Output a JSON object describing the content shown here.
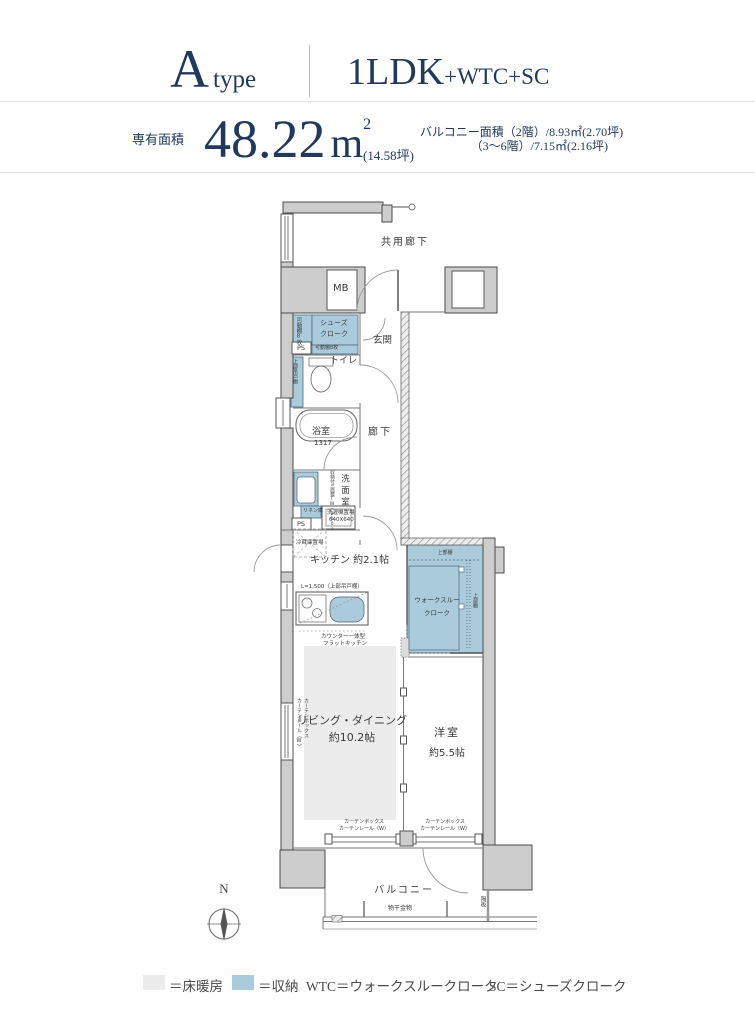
{
  "header": {
    "type_letter": "A",
    "type_word": "type",
    "plan_main": "1LDK",
    "plan_suffix": "+WTC+SC",
    "area_label": "専有面積",
    "area_value": "48.22",
    "area_unit_base": "m",
    "area_unit_sup": "2",
    "area_tsubo": "(14.58坪)",
    "balcony_line1": "バルコニー面積（2階）/8.93㎡(2.70坪)",
    "balcony_line2": "（3〜6階）/7.15㎡(2.16坪)"
  },
  "plan": {
    "common_corridor": "共用廊下",
    "mb": "MB",
    "shoes_closet_l1": "シューズ",
    "shoes_closet_l2": "クローク",
    "movable_shelf_side": "可動棚8枚",
    "movable_shelf_bottom": "可動棚8枚",
    "ps_top": "PS",
    "entrance": "玄関",
    "toilet": "トイレ",
    "hanging_cabinet": "上部吊戸棚",
    "bath": "浴室",
    "bath_size": "1317",
    "corridor": "廊下",
    "washroom": "洗面室",
    "mirror_cabinet": "収納付三面鏡(W=900)",
    "linen": "リネン庫",
    "washer_l1": "洗濯機置場",
    "washer_l2": "640X640",
    "ps_mid": "PS",
    "fridge": "冷蔵庫置場",
    "kitchen": "キッチン 約2.1帖",
    "kitchen_shelf": "L=1,500（上部吊戸棚）",
    "flat_kitchen_l1": "カウンター一体型",
    "flat_kitchen_l2": "フラットキッチン",
    "wtc_l1": "ウォークスルー",
    "wtc_l2": "クローク",
    "wtc_shelf_top": "上部棚",
    "wtc_shelf_right": "上部棚",
    "living_l1": "リビング・ダイニング",
    "living_l2": "約10.2帖",
    "curtain_box_v": "カーテンボックス",
    "curtain_rail_v": "カーテンレール（W）",
    "curtain_box1_l1": "カーテンボックス",
    "curtain_box1_l2": "カーテンレール（W）",
    "curtain_box2_l1": "カーテンボックス",
    "curtain_box2_l2": "カーテンレール（W）",
    "bedroom": "洋室",
    "bedroom_size": "約5.5帖",
    "balcony": "バルコニー",
    "drying_fixture": "物干金物",
    "partition_board": "隔板",
    "compass_n": "N"
  },
  "legend": {
    "floor_heating": "＝床暖房",
    "storage": "＝収納",
    "wtc": "WTC＝ウォークスルークローク",
    "sc": "SC＝シューズクローク"
  },
  "colors": {
    "navy": "#21395c",
    "storage_blue": "#a9cbdc",
    "floor_heating_gray": "#ececec",
    "wall_gray": "#cdcdcd"
  }
}
